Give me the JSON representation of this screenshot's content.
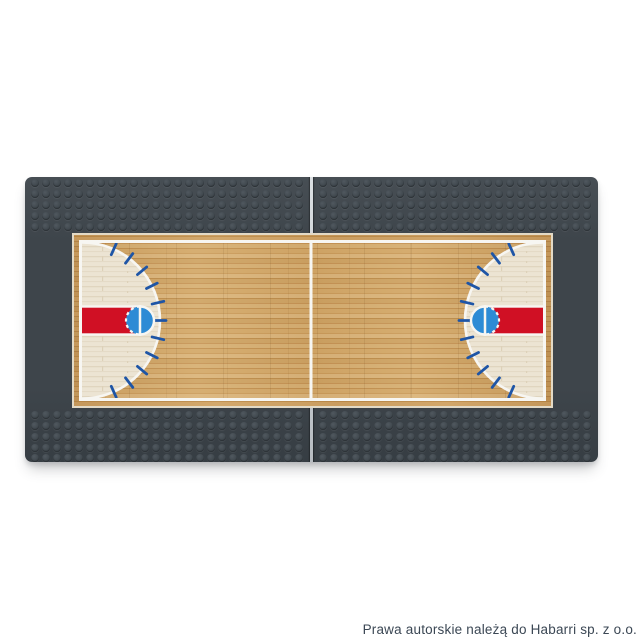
{
  "photo": {
    "description": "Dark gray building-brick baseplate made of two joined plates, printed with a wooden basketball court",
    "background_color": "#ffffff"
  },
  "watermark": {
    "text": "Prawa autorskie należą do Habarri sp. z o.o."
  },
  "colors": {
    "plate_gray": "#3e454b",
    "plate_gray_light": "#474e54",
    "seam_light": "#ccd1d5",
    "wood_base": "#cfa467",
    "wood_border": "#c6985c",
    "cream_zone": "#ece4d3",
    "line_white": "#f7f6f2",
    "lane_red": "#d01024",
    "circle_blue": "#2d8bd5",
    "tick_navy": "#1e55a6",
    "watermark_text": "#3b4754",
    "shadow": "rgba(70,76,82,0.32)"
  }
}
